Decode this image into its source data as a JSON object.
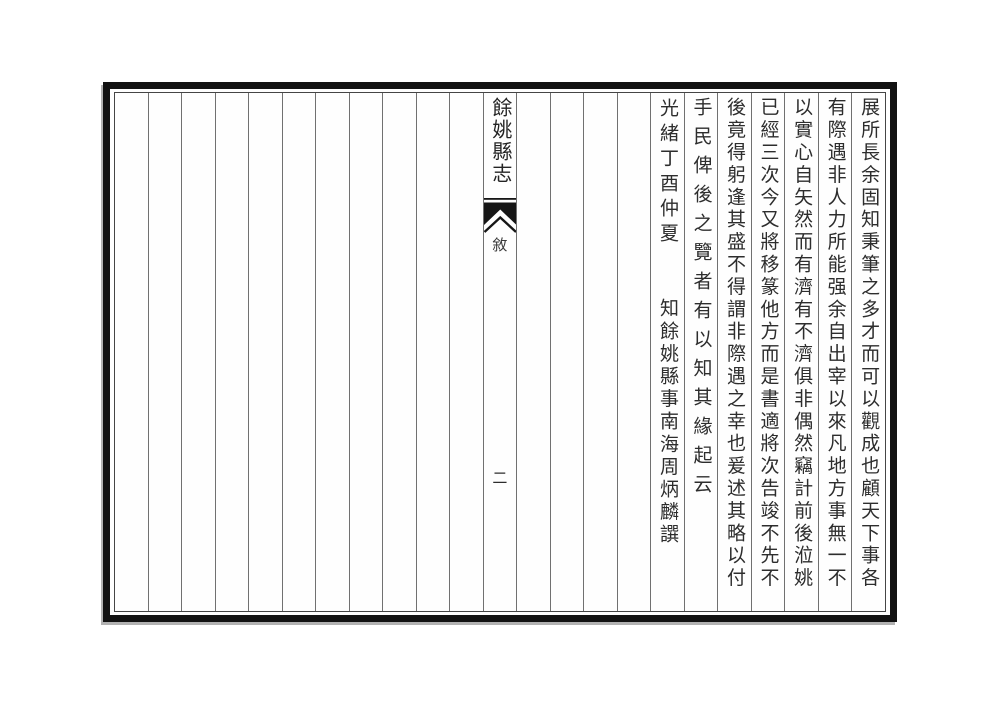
{
  "document": {
    "type_label": "classical Chinese gazetteer page, vertical text read right-to-left",
    "colors": {
      "page_background": "#fefefe",
      "outer_frame": "#121212",
      "inner_frame": "#454545",
      "rule_lines": "#707070",
      "text": "#2d2d2d"
    }
  },
  "banxin": {
    "title": "餘姚縣志",
    "section": "敘",
    "page_number": "二"
  },
  "columns_right_to_left": [
    {
      "text": "展所長余固知秉筆之多才而可以觀成也顧天下事各"
    },
    {
      "text": "有際遇非人力所能强余自出宰以來凡地方事無一不"
    },
    {
      "text": "以實心自矢然而有濟有不濟俱非偶然竊計前後涖姚"
    },
    {
      "text": "已經三次今又將移篆他方而是書適將次告竣不先不"
    },
    {
      "text": "後竟得躬逢其盛不得謂非際遇之幸也爰述其略以付"
    },
    {
      "text": "手民俾後之覽者有以知其緣起云"
    },
    {
      "top": "光緒丁酉仲夏",
      "bottom": "知餘姚縣事南海周炳麟譔"
    }
  ],
  "blank_columns": {
    "left_of_center_column": 11,
    "between_center_and_signature": 4
  }
}
